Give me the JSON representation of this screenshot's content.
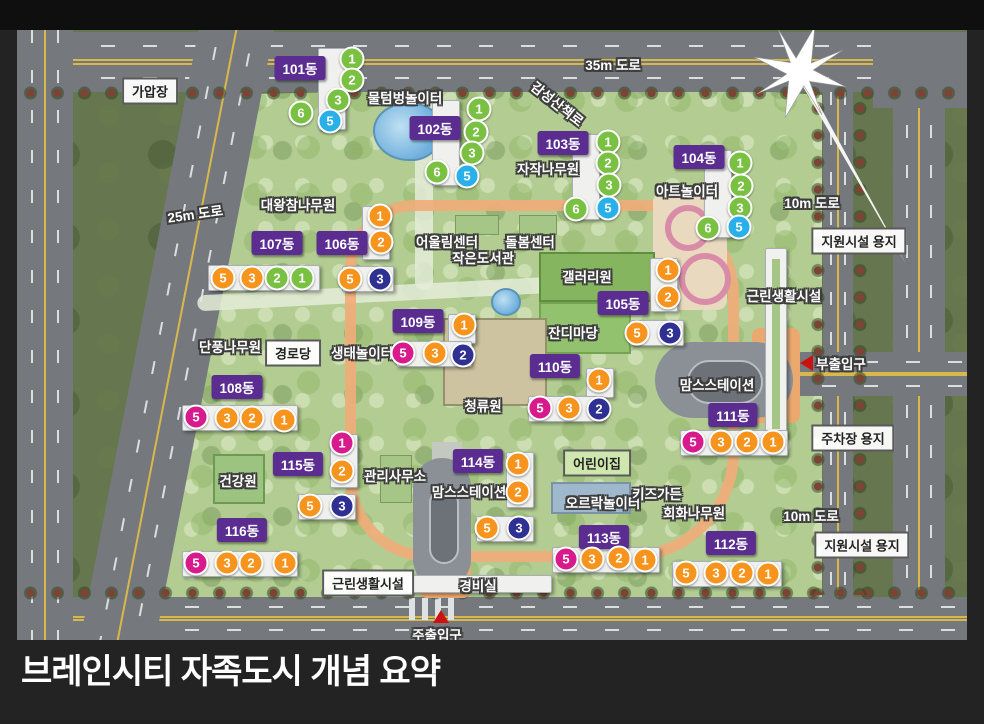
{
  "title": "브레인시티 자족도시 개념 요약",
  "colors": {
    "badge": "#5b2d90",
    "units": {
      "green": "#7ac143",
      "blue": "#29b0e8",
      "orange": "#f7941e",
      "navy": "#2e3192",
      "magenta": "#d81b8c"
    }
  },
  "blocks": [
    {
      "label": "101동",
      "badge": [
        300,
        68
      ],
      "slabs": [
        [
          318,
          48,
          26,
          80
        ]
      ],
      "units": [
        [
          "1",
          "green",
          352,
          59
        ],
        [
          "2",
          "green",
          352,
          80
        ],
        [
          "3",
          "green",
          338,
          100
        ],
        [
          "6",
          "green",
          301,
          113
        ],
        [
          "5",
          "blue",
          330,
          121
        ]
      ]
    },
    {
      "label": "102동",
      "badge": [
        435,
        128
      ],
      "slabs": [
        [
          432,
          100,
          26,
          84
        ]
      ],
      "units": [
        [
          "1",
          "green",
          479,
          109
        ],
        [
          "2",
          "green",
          476,
          132
        ],
        [
          "3",
          "green",
          472,
          153
        ],
        [
          "6",
          "green",
          437,
          172
        ],
        [
          "5",
          "blue",
          467,
          176
        ]
      ]
    },
    {
      "label": "103동",
      "badge": [
        563,
        143
      ],
      "slabs": [
        [
          572,
          134,
          26,
          84
        ]
      ],
      "units": [
        [
          "1",
          "green",
          608,
          142
        ],
        [
          "2",
          "green",
          608,
          163
        ],
        [
          "3",
          "green",
          609,
          185
        ],
        [
          "6",
          "green",
          576,
          209
        ],
        [
          "5",
          "blue",
          608,
          208
        ]
      ]
    },
    {
      "label": "104동",
      "badge": [
        699,
        157
      ],
      "slabs": [
        [
          704,
          150,
          26,
          86
        ]
      ],
      "units": [
        [
          "1",
          "green",
          740,
          163
        ],
        [
          "2",
          "green",
          741,
          186
        ],
        [
          "3",
          "green",
          740,
          208
        ],
        [
          "6",
          "green",
          708,
          228
        ],
        [
          "5",
          "blue",
          739,
          227
        ]
      ]
    },
    {
      "label": "107동",
      "badge": [
        277,
        243
      ],
      "slabs": [
        [
          208,
          265,
          110,
          24
        ]
      ],
      "units": [
        [
          "5",
          "orange",
          223,
          278
        ],
        [
          "3",
          "orange",
          252,
          278
        ],
        [
          "2",
          "green",
          277,
          278
        ],
        [
          "1",
          "green",
          302,
          278
        ]
      ]
    },
    {
      "label": "106동",
      "badge": [
        342,
        243
      ],
      "slabs": [
        [
          362,
          206,
          26,
          52
        ],
        [
          342,
          266,
          50,
          24
        ]
      ],
      "units": [
        [
          "1",
          "orange",
          380,
          216
        ],
        [
          "2",
          "orange",
          381,
          242
        ],
        [
          "5",
          "orange",
          350,
          279
        ],
        [
          "3",
          "navy",
          380,
          279
        ]
      ]
    },
    {
      "label": "105동",
      "badge": [
        623,
        303
      ],
      "slabs": [
        [
          650,
          258,
          26,
          52
        ],
        [
          630,
          320,
          52,
          24
        ]
      ],
      "units": [
        [
          "1",
          "orange",
          668,
          270
        ],
        [
          "2",
          "orange",
          668,
          297
        ],
        [
          "5",
          "orange",
          637,
          333
        ],
        [
          "3",
          "navy",
          670,
          333
        ]
      ]
    },
    {
      "label": "109동",
      "badge": [
        418,
        321
      ],
      "slabs": [
        [
          448,
          314,
          26,
          28
        ],
        [
          396,
          341,
          74,
          24
        ]
      ],
      "units": [
        [
          "1",
          "orange",
          464,
          325
        ],
        [
          "5",
          "magenta",
          403,
          353
        ],
        [
          "3",
          "orange",
          435,
          353
        ],
        [
          "2",
          "navy",
          463,
          355
        ]
      ]
    },
    {
      "label": "108동",
      "badge": [
        237,
        387
      ],
      "slabs": [
        [
          182,
          405,
          114,
          24
        ]
      ],
      "units": [
        [
          "5",
          "magenta",
          196,
          417
        ],
        [
          "3",
          "orange",
          227,
          418
        ],
        [
          "2",
          "orange",
          252,
          418
        ],
        [
          "1",
          "orange",
          284,
          420
        ]
      ]
    },
    {
      "label": "110동",
      "badge": [
        555,
        366
      ],
      "slabs": [
        [
          586,
          368,
          26,
          28
        ],
        [
          528,
          396,
          74,
          24
        ]
      ],
      "units": [
        [
          "1",
          "orange",
          599,
          380
        ],
        [
          "5",
          "magenta",
          540,
          408
        ],
        [
          "3",
          "orange",
          569,
          408
        ],
        [
          "2",
          "navy",
          599,
          409
        ]
      ]
    },
    {
      "label": "111동",
      "badge": [
        733,
        415
      ],
      "slabs": [
        [
          680,
          430,
          106,
          24
        ]
      ],
      "units": [
        [
          "5",
          "magenta",
          693,
          442
        ],
        [
          "3",
          "orange",
          721,
          442
        ],
        [
          "2",
          "orange",
          747,
          442
        ],
        [
          "1",
          "orange",
          773,
          442
        ]
      ]
    },
    {
      "label": "115동",
      "badge": [
        298,
        464
      ],
      "slabs": [
        [
          330,
          434,
          26,
          52
        ],
        [
          298,
          494,
          56,
          24
        ]
      ],
      "units": [
        [
          "1",
          "magenta",
          342,
          443
        ],
        [
          "2",
          "orange",
          342,
          471
        ],
        [
          "5",
          "orange",
          310,
          506
        ],
        [
          "3",
          "navy",
          342,
          506
        ]
      ]
    },
    {
      "label": "114동",
      "badge": [
        478,
        461
      ],
      "slabs": [
        [
          506,
          452,
          26,
          54
        ],
        [
          476,
          516,
          56,
          24
        ]
      ],
      "units": [
        [
          "1",
          "orange",
          518,
          464
        ],
        [
          "2",
          "orange",
          518,
          492
        ],
        [
          "5",
          "orange",
          487,
          528
        ],
        [
          "3",
          "navy",
          519,
          528
        ]
      ]
    },
    {
      "label": "116동",
      "badge": [
        242,
        530
      ],
      "slabs": [
        [
          182,
          551,
          114,
          24
        ]
      ],
      "units": [
        [
          "5",
          "magenta",
          196,
          563
        ],
        [
          "3",
          "orange",
          227,
          563
        ],
        [
          "2",
          "orange",
          251,
          563
        ],
        [
          "1",
          "orange",
          285,
          563
        ]
      ]
    },
    {
      "label": "113동",
      "badge": [
        604,
        537
      ],
      "slabs": [
        [
          552,
          547,
          106,
          24
        ]
      ],
      "units": [
        [
          "5",
          "magenta",
          566,
          559
        ],
        [
          "3",
          "orange",
          592,
          559
        ],
        [
          "2",
          "orange",
          619,
          558
        ],
        [
          "1",
          "orange",
          645,
          560
        ]
      ]
    },
    {
      "label": "112동",
      "badge": [
        731,
        543
      ],
      "slabs": [
        [
          672,
          561,
          108,
          24
        ]
      ],
      "units": [
        [
          "5",
          "orange",
          686,
          573
        ],
        [
          "3",
          "orange",
          716,
          573
        ],
        [
          "2",
          "orange",
          742,
          573
        ],
        [
          "1",
          "orange",
          768,
          574
        ]
      ]
    }
  ],
  "facilities": [
    [
      "물텀벙놀이터",
      405,
      97,
      0
    ],
    [
      "감성산책로",
      558,
      103,
      38
    ],
    [
      "자작나무원",
      548,
      168,
      0
    ],
    [
      "아트놀이터",
      687,
      190,
      0
    ],
    [
      "대왕참나무원",
      298,
      204,
      0
    ],
    [
      "어울림센터",
      447,
      241,
      0
    ],
    [
      "돌봄센터",
      530,
      241,
      0
    ],
    [
      "작은도서관",
      483,
      257,
      0
    ],
    [
      "갤러리원",
      587,
      276,
      0
    ],
    [
      "근린생활시설",
      784,
      295,
      0
    ],
    [
      "단풍나무원",
      230,
      346,
      0
    ],
    [
      "생태놀이터",
      362,
      352,
      0
    ],
    [
      "잔디마당",
      573,
      332,
      0
    ],
    [
      "청류원",
      483,
      405,
      0
    ],
    [
      "맘스스테이션",
      717,
      384,
      0
    ],
    [
      "맘스스테이션",
      469,
      491,
      0
    ],
    [
      "오르락놀이터",
      603,
      502,
      0
    ],
    [
      "키즈가든",
      657,
      493,
      0
    ],
    [
      "회화나무원",
      694,
      512,
      0
    ],
    [
      "건강원",
      238,
      480,
      0
    ],
    [
      "관리사무소",
      395,
      475,
      0
    ],
    [
      "경비실",
      478,
      585,
      0
    ]
  ],
  "boxed_labels": [
    [
      "가압장",
      150,
      91,
      "white"
    ],
    [
      "경로당",
      293,
      353,
      "white"
    ],
    [
      "지원시설 용지",
      859,
      241,
      "white"
    ],
    [
      "주차장 용지",
      853,
      438,
      "white"
    ],
    [
      "지원시설 용지",
      862,
      545,
      "white"
    ],
    [
      "근린생활시설",
      368,
      583,
      "white"
    ],
    [
      "어린이집",
      597,
      463,
      "green"
    ]
  ],
  "road_labels": [
    [
      "35m 도로",
      613,
      64,
      0
    ],
    [
      "25m 도로",
      195,
      213,
      -8
    ],
    [
      "10m 도로",
      812,
      202,
      0
    ],
    [
      "10m 도로",
      811,
      515,
      0
    ]
  ],
  "entrances": [
    {
      "label": "부출입구",
      "x": 841,
      "y": 363,
      "dir": "left",
      "tx": 800,
      "ty": 355
    },
    {
      "label": "주출입구",
      "x": 437,
      "y": 634,
      "dir": "up",
      "tx": 433,
      "ty": 610
    }
  ],
  "compass_name": "north-compass"
}
